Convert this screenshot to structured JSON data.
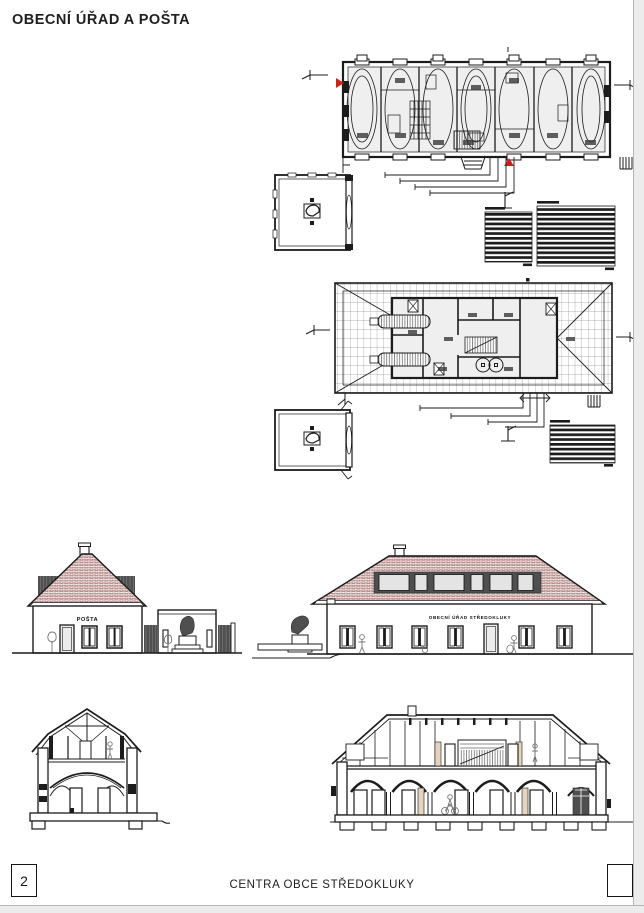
{
  "page": {
    "title": "OBECNÍ ÚŘAD A POŠTA"
  },
  "elevations": {
    "posta_label": "POŠTA",
    "urad_label": "OBECNÍ ÚŘAD STŘEDOKLUKY"
  },
  "footer": {
    "sheet_number": "2",
    "project_title": "CENTRA OBCE STŘEDOKLUKY"
  },
  "colors": {
    "ink": "#1c1c1c",
    "marker_red": "#c9261b",
    "roof_tile": "#b9908d",
    "dormer_dark": "#4f4f4f",
    "glass": "#e4e4e4",
    "tan": "#e6d3bc",
    "page_edge": "#ececec"
  }
}
